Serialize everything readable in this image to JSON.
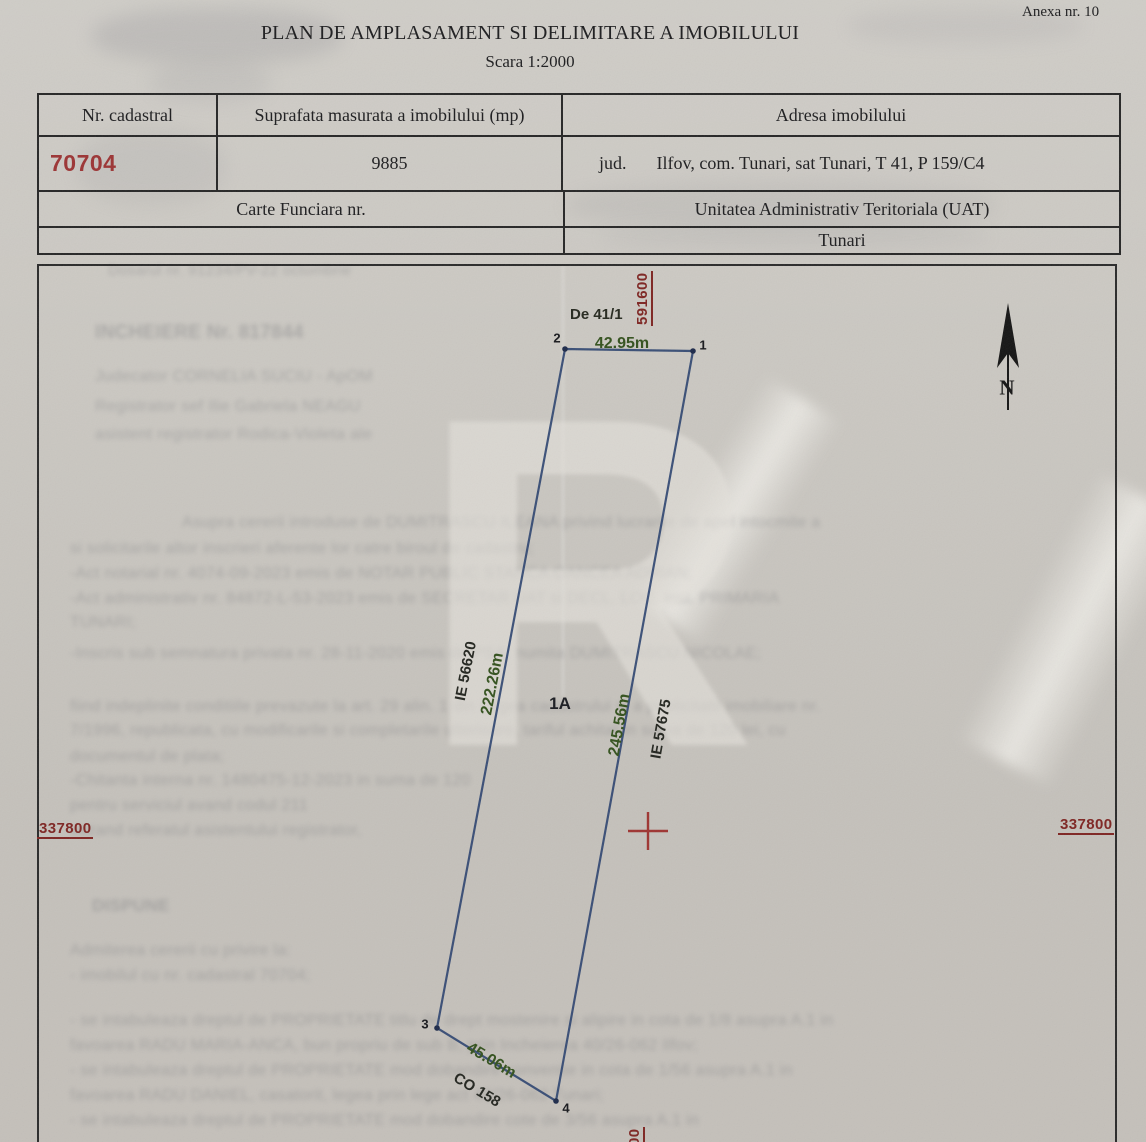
{
  "document": {
    "annex": "Anexa nr. 10",
    "title": "PLAN DE AMPLASAMENT SI DELIMITARE A IMOBILULUI",
    "scale": "Scara 1:2000"
  },
  "table": {
    "col_cadastral_header": "Nr. cadastral",
    "col_area_header": "Suprafata masurata a imobilului (mp)",
    "col_address_header": "Adresa imobilului",
    "cadastral_number": "70704",
    "measured_area": "9885",
    "address_prefix": "jud.",
    "address": "Ilfov, com. Tunari, sat Tunari, T 41, P 159/C4",
    "land_book_label": "Carte Funciara nr.",
    "uat_label": "Unitatea Administrativ Teritoriala (UAT)",
    "uat_value": "Tunari"
  },
  "plan": {
    "road_label": "De 41/1",
    "parcel_label": "1A",
    "north_label": "N",
    "grid_x_label": "591600",
    "grid_x_label_bottom": "591600",
    "grid_y_label_left": "337800",
    "grid_y_label_right": "337800",
    "point_1": "1",
    "point_2": "2",
    "point_3": "3",
    "point_4": "4",
    "top_length": "42.95m",
    "left_length": "222.26m",
    "left_neighbor": "IE 56620",
    "right_length": "245.56m",
    "right_neighbor": "IE 57675",
    "bottom_length": "45.06m",
    "bottom_neighbor": "CO 158",
    "colors": {
      "boundary_blue": "#2e4470",
      "dimension_green": "#33511d",
      "grid_red": "#7e2522",
      "cadastral_red": "#9c3434"
    }
  },
  "watermark": {
    "glyph": "R"
  },
  "bleedthrough": {
    "lines": [
      {
        "x": 108,
        "y": 262,
        "s": 15,
        "w": 400,
        "t": "Dosarul nr. 91234/PV-22 octombrie"
      },
      {
        "x": 95,
        "y": 322,
        "s": 19,
        "w": 700,
        "t": "INCHEIERE Nr. 817844"
      },
      {
        "x": 95,
        "y": 368,
        "s": 16,
        "w": 400,
        "t": "Judecator CORNELIA SUCIU - ApOM"
      },
      {
        "x": 95,
        "y": 398,
        "s": 16,
        "w": 400,
        "t": "Registrator sef Ilie Gabriela NEAGU"
      },
      {
        "x": 95,
        "y": 426,
        "s": 16,
        "w": 400,
        "t": "asistent registrator Rodica-Violeta ale"
      },
      {
        "x": 182,
        "y": 514,
        "s": 16,
        "w": 400,
        "t": "Asupra cererii introduse de DUMITRASCU ILEANA privind lucrarile de apel intocmite a"
      },
      {
        "x": 70,
        "y": 540,
        "s": 16,
        "w": 400,
        "t": "si solicitarile altor inscrieri aferente lor catre biroul de cadastru;"
      },
      {
        "x": 70,
        "y": 565,
        "s": 16,
        "w": 400,
        "t": "-Act notarial nr. 4074-09-2023 emis de NOTAR PUBLIC STANCA OANCEA ADRIAN;"
      },
      {
        "x": 70,
        "y": 590,
        "s": 16,
        "w": 400,
        "t": "-Act administrativ nr. 84872-L-53-2023 emis de SECRETAR UAT si DECL. LOC. inst. PRIMARIA"
      },
      {
        "x": 70,
        "y": 614,
        "s": 16,
        "w": 400,
        "t": "TUNARI;"
      },
      {
        "x": 70,
        "y": 645,
        "s": 16,
        "w": 400,
        "t": "-Inscris sub semnatura privata nr. 28-11-2020 emis de PSA; numita DUMITRASCU NICOLAE;"
      },
      {
        "x": 70,
        "y": 698,
        "s": 16,
        "w": 400,
        "t": "fiind indeplinite conditiile prevazute la art. 29 alin. 1 din Legea cadastrului si a publicitatii imobiliare nr."
      },
      {
        "x": 70,
        "y": 722,
        "s": 16,
        "w": 400,
        "t": "7/1996, republicata, cu modificarile si completarile ulterioare, tariful achitat in suma de 120 lei, cu"
      },
      {
        "x": 70,
        "y": 748,
        "s": 16,
        "w": 400,
        "t": "documentul de plata;"
      },
      {
        "x": 70,
        "y": 772,
        "s": 16,
        "w": 400,
        "t": "-Chitanta interna nr. 1480475-12-2023 in suma de 120"
      },
      {
        "x": 70,
        "y": 797,
        "s": 16,
        "w": 400,
        "t": "pentru serviciul avand codul 211"
      },
      {
        "x": 70,
        "y": 822,
        "s": 16,
        "w": 400,
        "t": "vazand referatul asistentului registrator,"
      },
      {
        "x": 92,
        "y": 896,
        "s": 17,
        "w": 700,
        "t": "DISPUNE"
      },
      {
        "x": 70,
        "y": 942,
        "s": 16,
        "w": 400,
        "t": "Admiterea cererii cu privire la:"
      },
      {
        "x": 70,
        "y": 967,
        "s": 16,
        "w": 400,
        "t": "- imobilul cu nr. cadastral 70704;"
      },
      {
        "x": 70,
        "y": 1012,
        "s": 16,
        "w": 400,
        "t": "- se intabuleaza dreptul de PROPRIETATE titlu de drept mostenire si alipire in cota de 1/8 asupra A.1 in"
      },
      {
        "x": 70,
        "y": 1037,
        "s": 16,
        "w": 400,
        "t": "favoarea RADU MARIA-ANCA, bun propriu de sub B, prin Incheierea 40/26-062 Ilfov;"
      },
      {
        "x": 70,
        "y": 1062,
        "s": 16,
        "w": 400,
        "t": "- se intabuleaza dreptul de PROPRIETATE mod dobandire conventie in cota de 1/56 asupra A.1 in"
      },
      {
        "x": 70,
        "y": 1087,
        "s": 16,
        "w": 400,
        "t": "favoarea RADU DANIEL, casatorit, legea prin lege act 40/26-062 Tunari;"
      },
      {
        "x": 70,
        "y": 1112,
        "s": 16,
        "w": 400,
        "t": "- se intabuleaza dreptul de PROPRIETATE mod dobandire cote de 3/56 asupra A.1 in"
      }
    ],
    "blotches": [
      {
        "x": 92,
        "y": 8,
        "w": 250,
        "h": 56,
        "o": 0.2
      },
      {
        "x": 150,
        "y": 62,
        "w": 120,
        "h": 40,
        "o": 0.12
      },
      {
        "x": 76,
        "y": 128,
        "w": 150,
        "h": 78,
        "o": 0.1
      },
      {
        "x": 848,
        "y": 8,
        "w": 235,
        "h": 36,
        "o": 0.1
      },
      {
        "x": 566,
        "y": 182,
        "w": 430,
        "h": 46,
        "o": 0.12
      },
      {
        "x": 600,
        "y": 224,
        "w": 390,
        "h": 26,
        "o": 0.09
      }
    ]
  }
}
